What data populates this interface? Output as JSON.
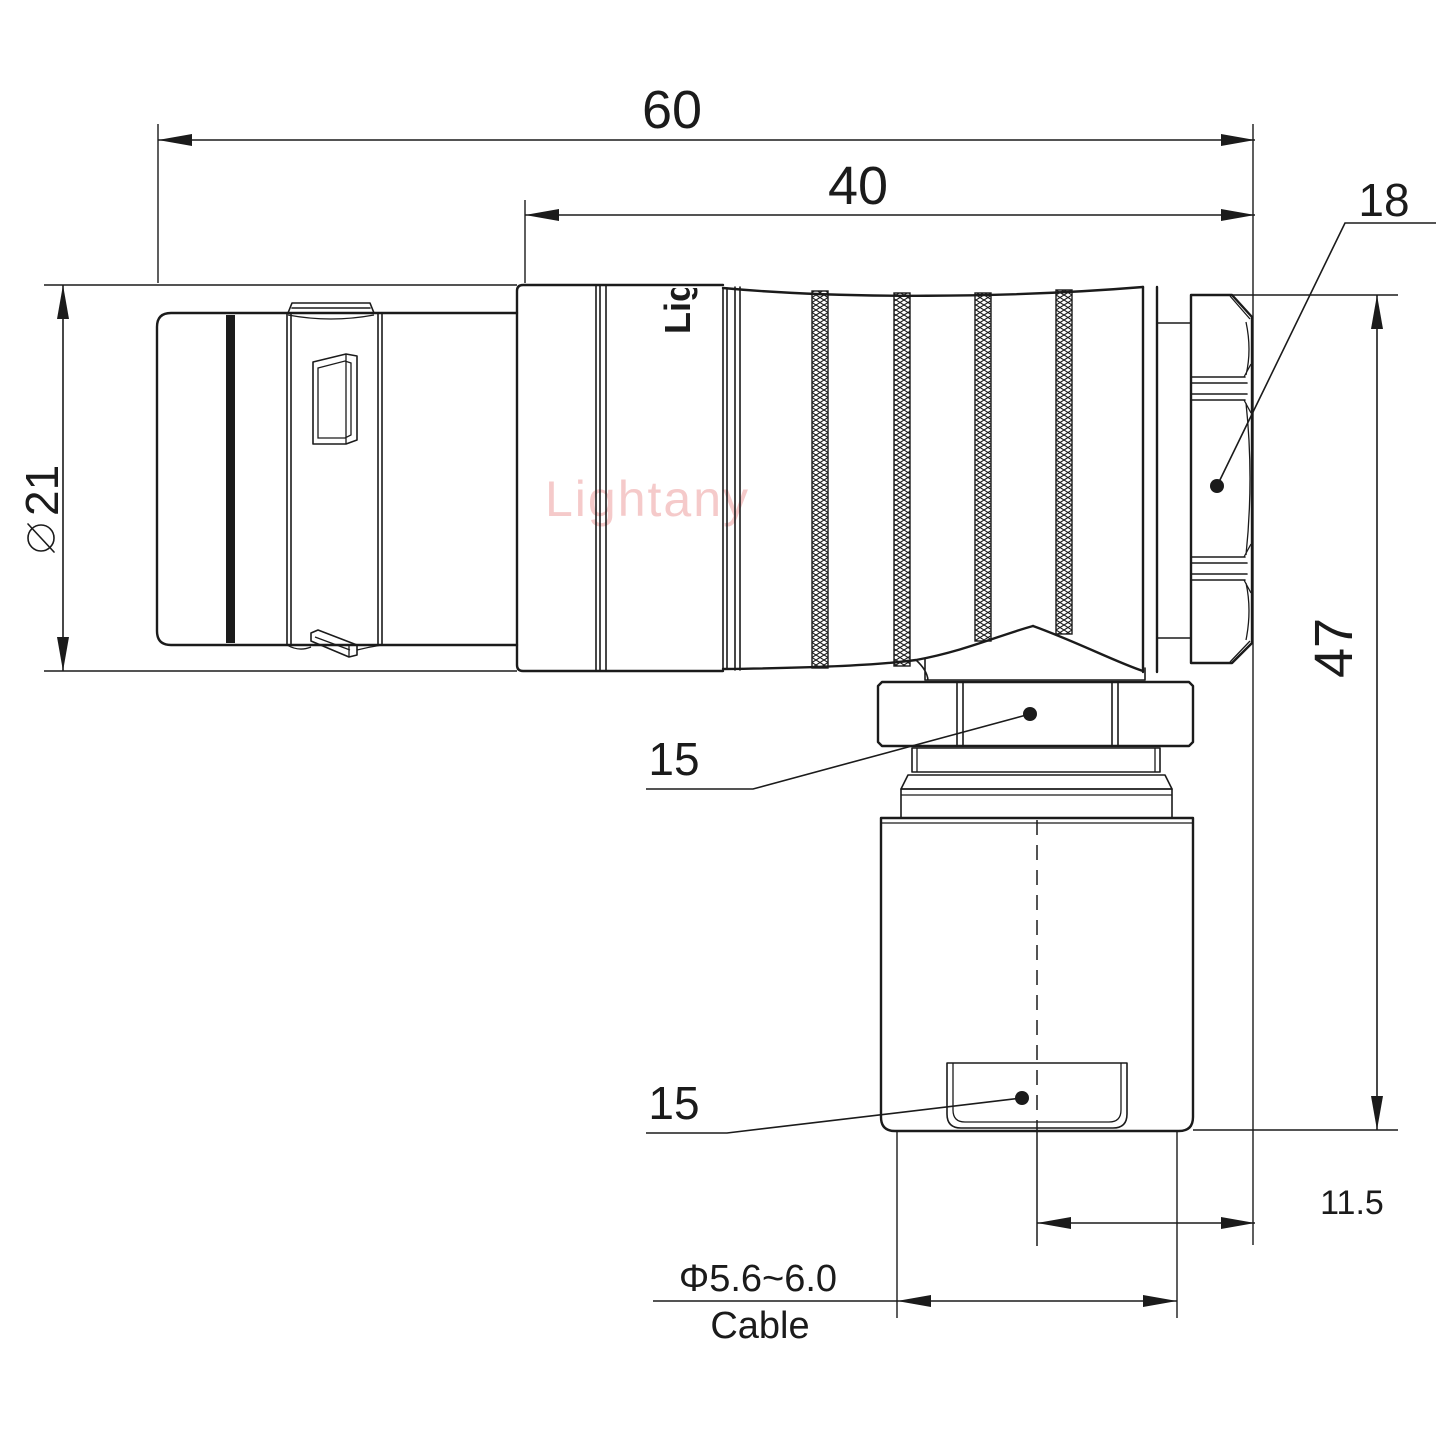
{
  "colors": {
    "line": "#1b1b1b",
    "watermark": "#f5caca",
    "background": "#ffffff"
  },
  "watermark": {
    "text": "Lightany"
  },
  "part_marking": {
    "text": "Lig"
  },
  "dims": {
    "overall_length": "60",
    "body_length": "40",
    "backnut": "18",
    "front_diameter_symbol": "⌀",
    "front_diameter_value": "21",
    "coupling_nut": "15",
    "cable_clamp_nut": "15",
    "height": "47",
    "cable_offset": "11.5",
    "cable_diameter": "Φ5.6~6.0",
    "cable_caption": "Cable"
  }
}
